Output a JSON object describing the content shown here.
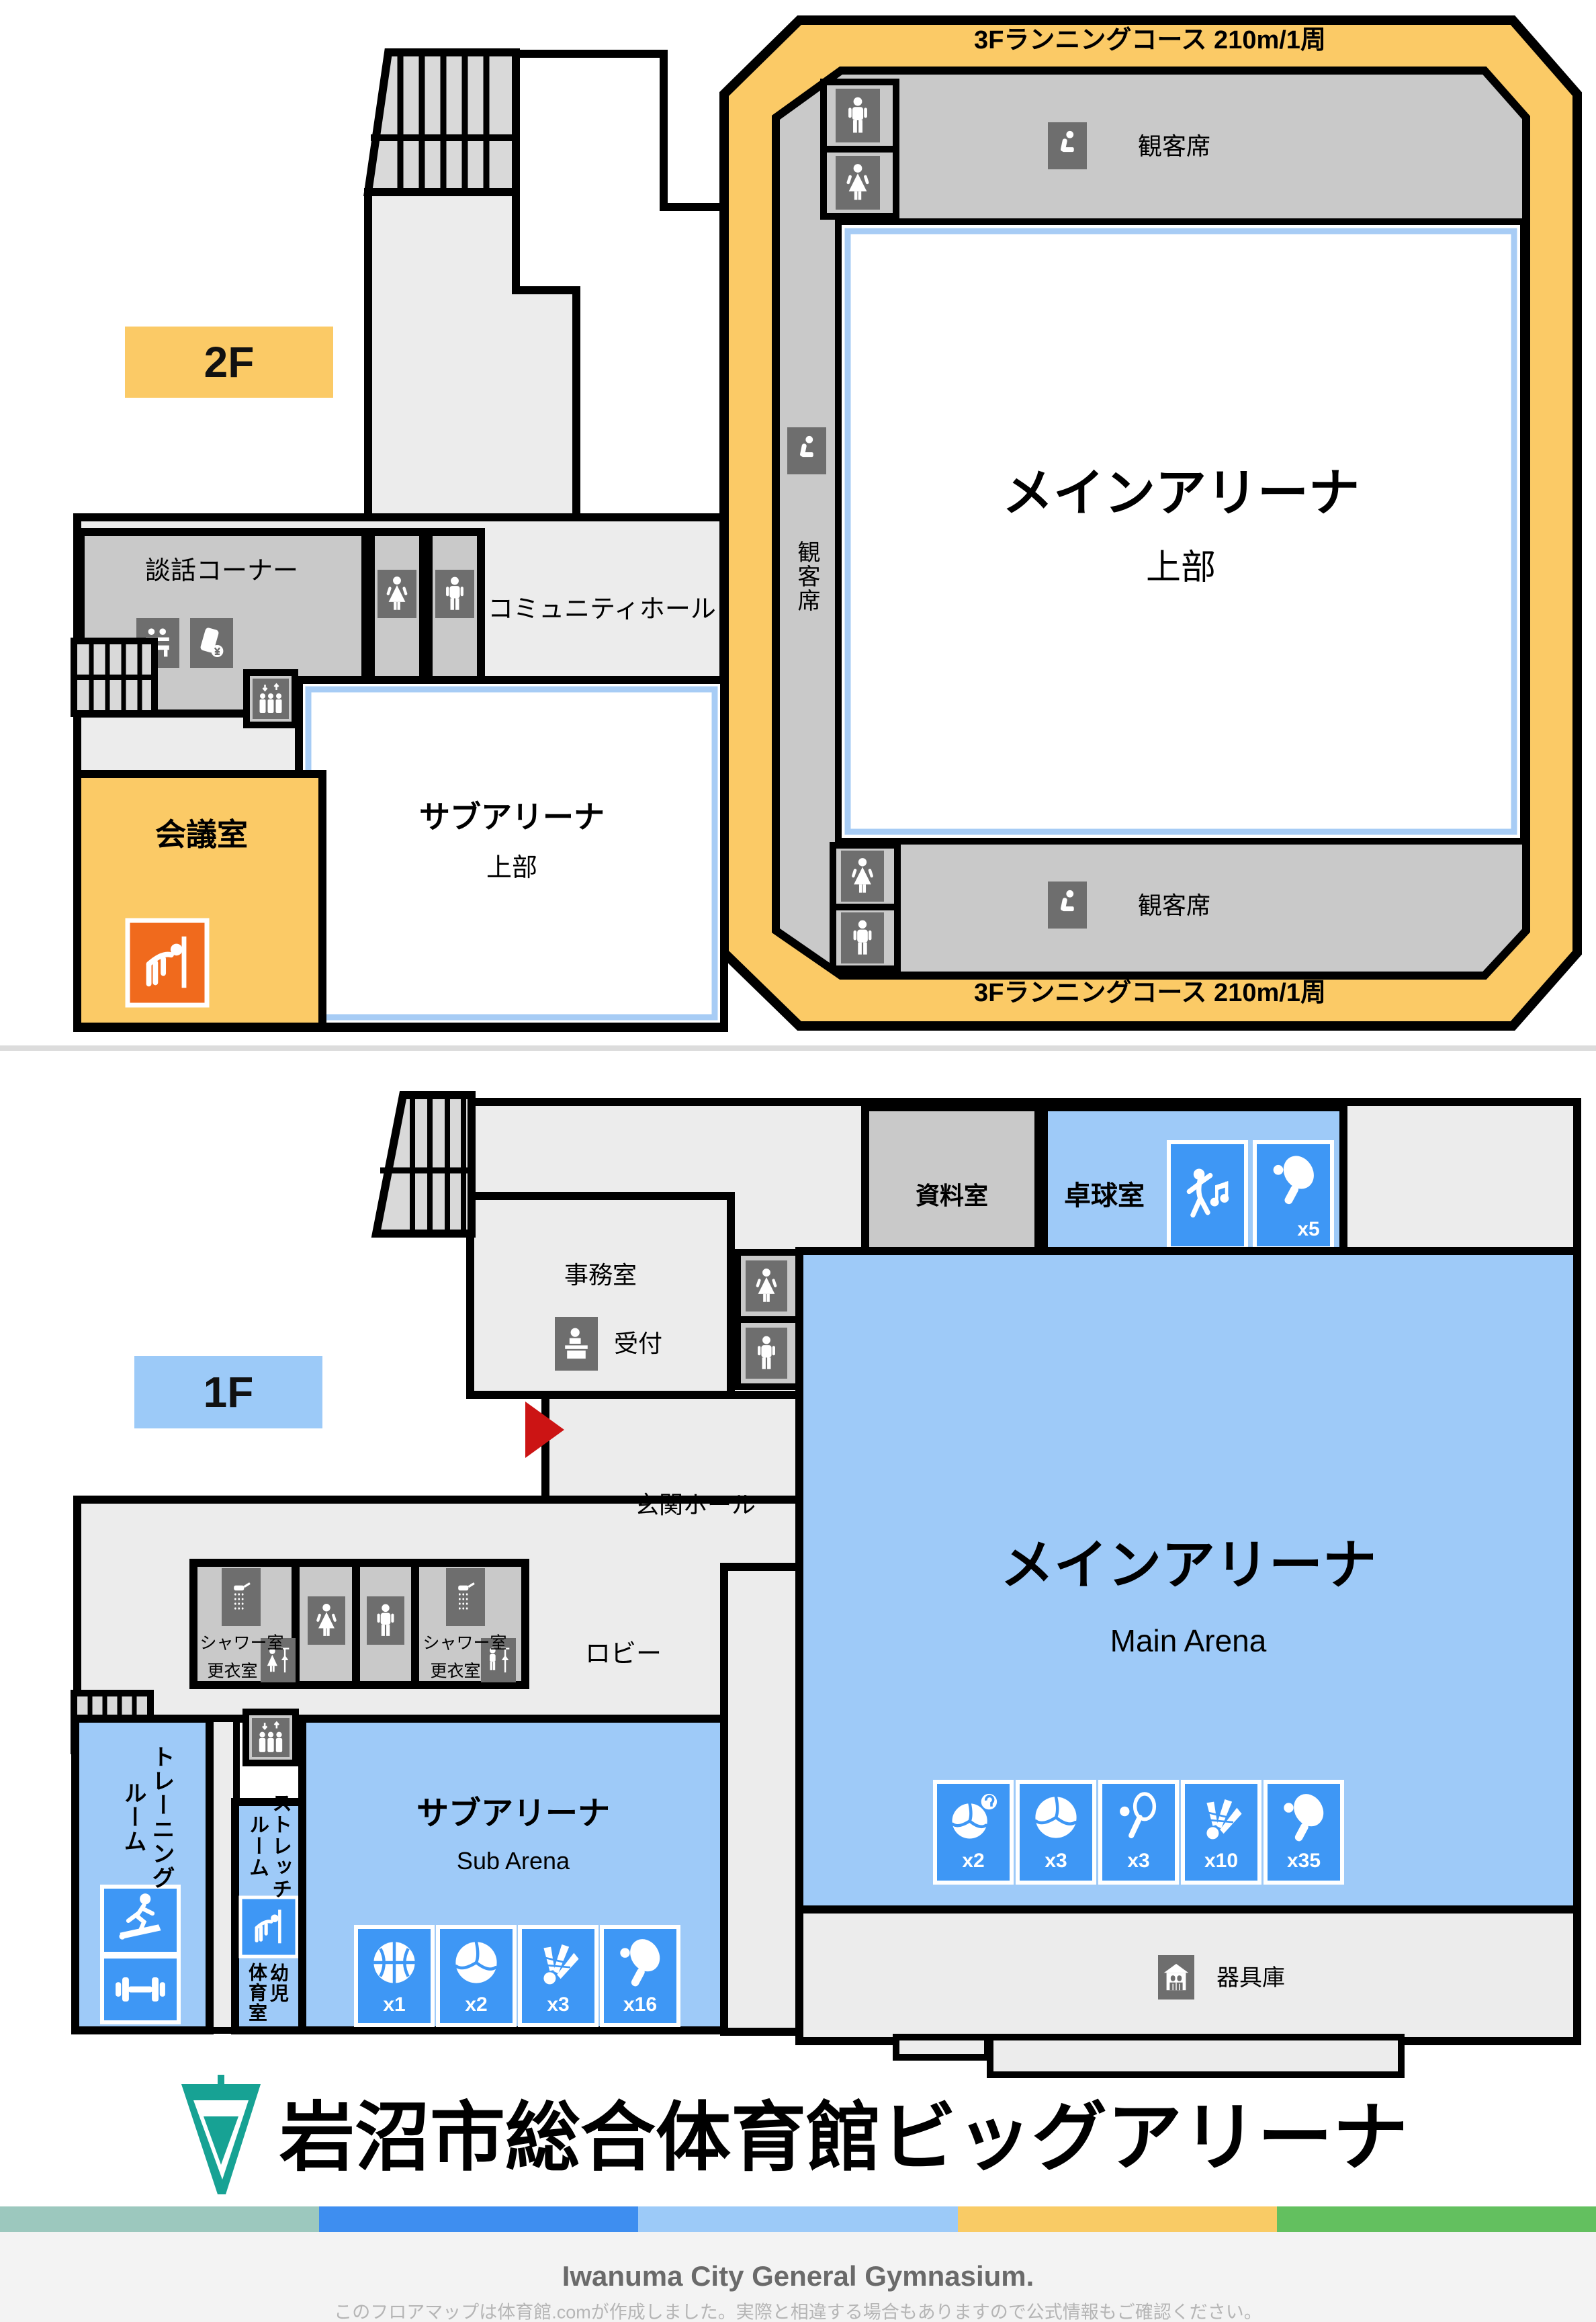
{
  "floor2": {
    "badge": "2F",
    "running_course": "3Fランニングコース 210m/1周",
    "spectator_seats": "観客席",
    "main_arena": {
      "title": "メインアリーナ",
      "subtitle": "上部"
    },
    "chat_corner": "談話コーナー",
    "community_hall": "コミュニティホール",
    "meeting_room": "会議室",
    "sub_arena": {
      "title": "サブアリーナ",
      "subtitle": "上部"
    }
  },
  "floor1": {
    "badge": "1F",
    "archive_room": "資料室",
    "table_tennis_room": {
      "title": "卓球室",
      "icons": [
        {
          "sport": "dance",
          "count": ""
        },
        {
          "sport": "table-tennis",
          "count": "x5"
        }
      ]
    },
    "office": "事務室",
    "reception": "受付",
    "entrance_hall": "玄関ホール",
    "lobby": "ロビー",
    "shower_room": "シャワー室",
    "changing_room": "更衣室",
    "training_room": {
      "line1": "トレーニング",
      "line2": "ルーム"
    },
    "stretch_room": {
      "line1": "ストレッチ",
      "line2": "ルーム"
    },
    "infant_gym": {
      "line1": "幼児",
      "line2": "体育室"
    },
    "sub_arena": {
      "title": "サブアリーナ",
      "subtitle": "Sub Arena",
      "icons": [
        {
          "sport": "basketball",
          "count": "x1"
        },
        {
          "sport": "volleyball",
          "count": "x2"
        },
        {
          "sport": "badminton",
          "count": "x3"
        },
        {
          "sport": "table-tennis",
          "count": "x16"
        }
      ]
    },
    "main_arena": {
      "title": "メインアリーナ",
      "subtitle": "Main Arena",
      "icons": [
        {
          "sport": "soft-volleyball",
          "count": "x2"
        },
        {
          "sport": "volleyball",
          "count": "x3"
        },
        {
          "sport": "tennis",
          "count": "x3"
        },
        {
          "sport": "badminton",
          "count": "x10"
        },
        {
          "sport": "table-tennis",
          "count": "x35"
        }
      ]
    },
    "equipment_storage": "器具庫"
  },
  "footer": {
    "facility_name": "岩沼市総合体育館ビッグアリーナ",
    "facility_name_en": "Iwanuma City General Gymnasium.",
    "note": "このフロアマップは体育館.comが作成しました。実際と相違する場合もありますので公式情報もご確認ください。"
  },
  "colors": {
    "track_orange": "#FBCA66",
    "badge_2f": "#FBCA66",
    "badge_1f": "#9CCAF8",
    "room_light_blue": "#9ECAF8",
    "sport_icon_blue": "#3E97F5",
    "icon_dark_gray": "#6E6E6E",
    "room_gray": "#C9C9C9",
    "floor_gray": "#ECECEC",
    "meeting_icon_orange": "#F06A1D",
    "entrance_arrow_red": "#CC1414",
    "logo_teal": "#17A294",
    "stripe": [
      "#9CC8BE",
      "#3E8EF0",
      "#9CCAF8",
      "#F9CB65",
      "#63C05F"
    ]
  }
}
